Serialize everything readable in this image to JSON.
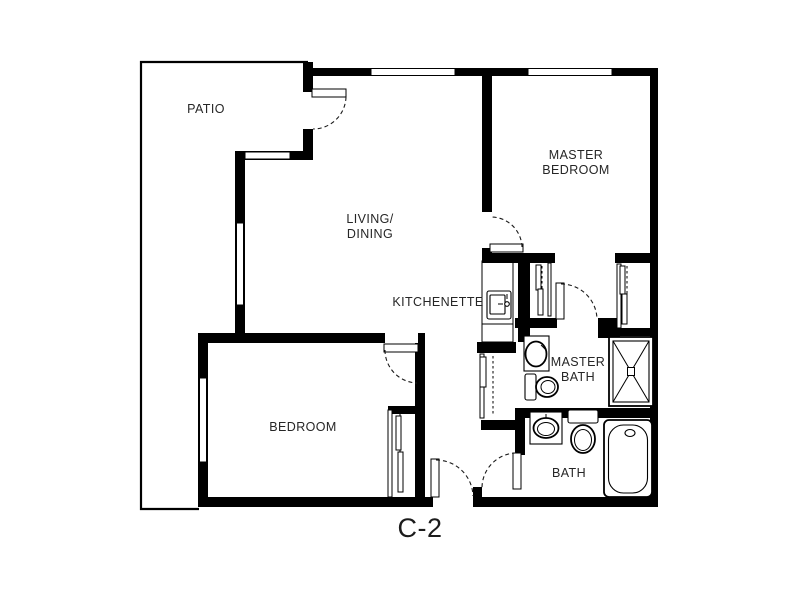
{
  "title": "Apartment floor plan",
  "unit": {
    "label": "C-2"
  },
  "rooms": {
    "patio": {
      "label": "PATIO"
    },
    "living_dining": {
      "label_lines": [
        "LIVING/",
        "DINING"
      ]
    },
    "master_bedroom": {
      "label_lines": [
        "MASTER",
        "BEDROOM"
      ]
    },
    "kitchenette": {
      "label": "KITCHENETTE"
    },
    "master_bath": {
      "label_lines": [
        "MASTER",
        "BATH"
      ]
    },
    "bedroom": {
      "label": "BEDROOM"
    },
    "bath": {
      "label": "BATH"
    }
  },
  "fixtures": [
    "kitchen-sink",
    "master-bath-sink",
    "master-bath-toilet",
    "shower",
    "bath-sink",
    "bath-toilet",
    "bathtub"
  ],
  "colors": {
    "wall": "#000000",
    "background": "#ffffff",
    "text": "#262626"
  }
}
